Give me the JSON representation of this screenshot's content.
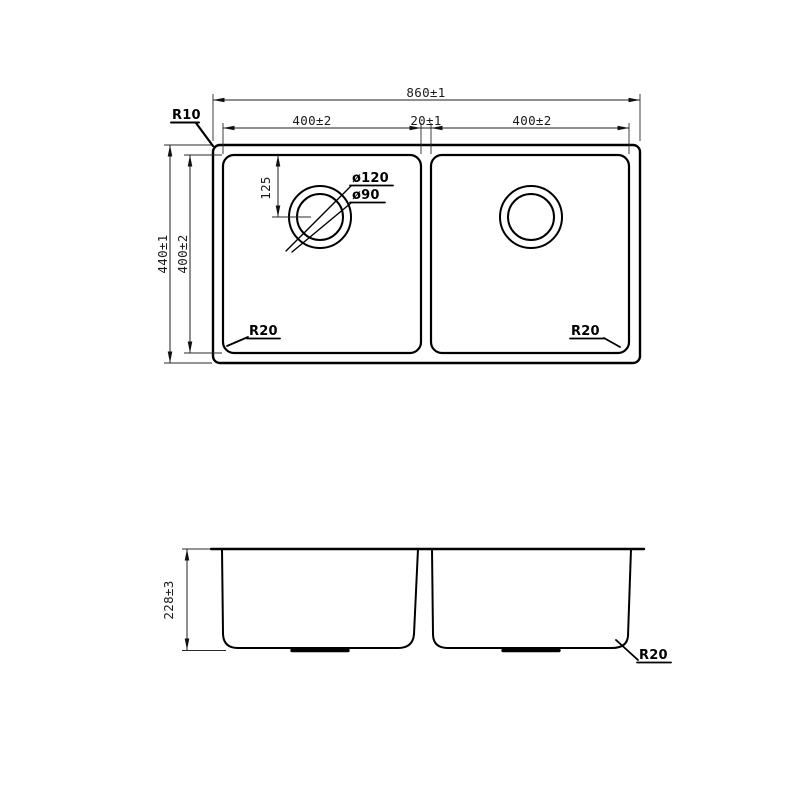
{
  "drawing": {
    "background": "#ffffff",
    "line_color": "#000000",
    "dim_color": "#1f1f1f"
  },
  "top_view": {
    "dim_overall_width": "860±1",
    "dim_left_bowl_width": "400±2",
    "dim_center_divider": "20±1",
    "dim_right_bowl_width": "400±2",
    "dim_overall_depth": "440±1",
    "dim_bowl_inner_depth": "400±2",
    "dim_drain_center_offset": "125",
    "label_rim_corner_radius": "R10",
    "label_drain_outer_dia": "ø120",
    "label_drain_inner_dia": "ø90",
    "label_left_bowl_corner_radius": "R20",
    "label_right_bowl_corner_radius": "R20"
  },
  "side_view": {
    "dim_bowl_height": "228±3",
    "label_bottom_corner_radius": "R20"
  }
}
